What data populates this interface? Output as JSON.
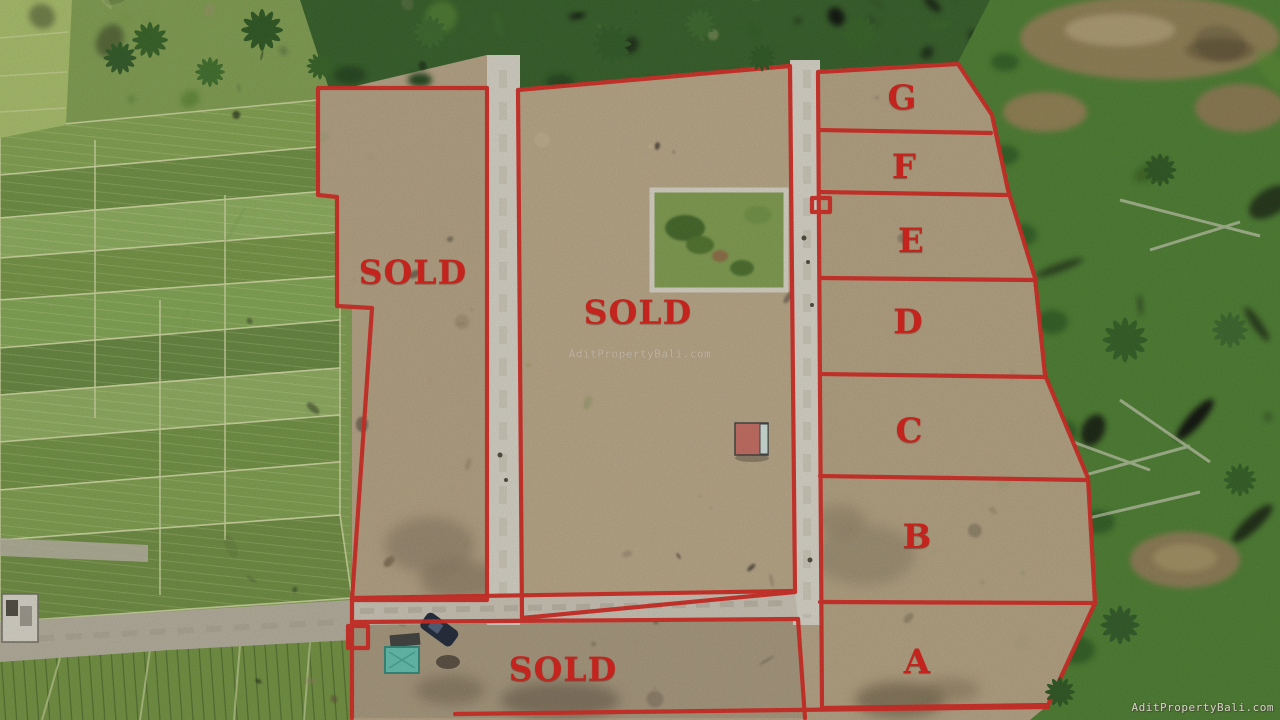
{
  "plots": {
    "left": {
      "label": "SOLD"
    },
    "center": {
      "label": "SOLD"
    },
    "bottom": {
      "label": "SOLD"
    },
    "g": {
      "label": "G"
    },
    "f": {
      "label": "F"
    },
    "e": {
      "label": "E"
    },
    "d": {
      "label": "D"
    },
    "c": {
      "label": "C"
    },
    "b": {
      "label": "B"
    },
    "a": {
      "label": "A"
    }
  },
  "watermarks": {
    "center": "AditPropertyBali.com",
    "corner": "AditPropertyBali.com"
  },
  "colors": {
    "boundary_red": "#d2231c",
    "label_red": "#c3241d",
    "dirt_tan": "#b4a183",
    "rice_green": "#7d9c4c",
    "jungle_green": "#477a2b",
    "path_gray": "#d6d2c6"
  }
}
